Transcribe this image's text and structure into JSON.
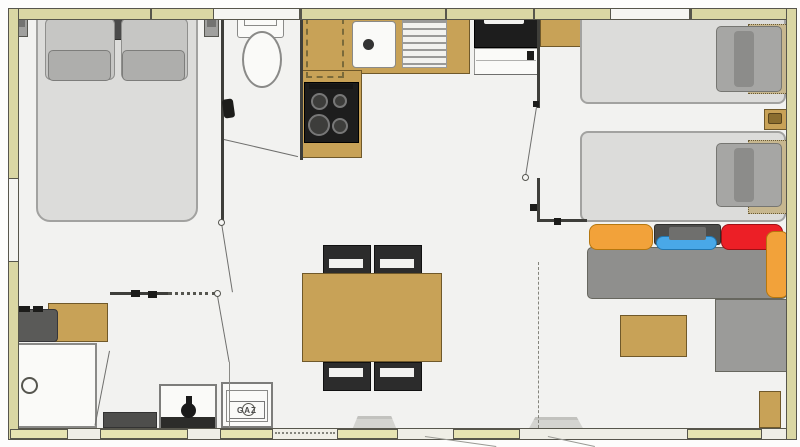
{
  "labels": {
    "gaz": "GAZ"
  },
  "colors": {
    "wall_band": "#dad7a4",
    "wall_band_border": "#57564c",
    "window_white": "#f5f5f2",
    "window_strip": "#e6e3b2",
    "bottom_band": "#efeee6",
    "wall_dark": "#3e3e3a",
    "floor": "#f2f2f0",
    "wood": "#c8a257",
    "wood_border": "#70592a",
    "wood_light": "#c7b78f",
    "wood_light_border": "#6b5b33",
    "mattress": "#dcdcda",
    "mattress_border": "#a2a2a0",
    "pillow": "#c6c6c4",
    "pillow_border": "#8f8f8d",
    "pillow_small": "#aeaeac",
    "pillow_twin": "#a6a6a4",
    "headboard": "#4a4a4a",
    "sofa": "#8f8f8d",
    "sofa_border": "#67675f",
    "chaise": "#9b9b99",
    "orange": "#f2a23a",
    "orange_border": "#b5770f",
    "red": "#ec1f26",
    "red_border": "#9e1116",
    "blue": "#49a8e8",
    "blue_border": "#2277b0",
    "dark_cushion": "#4e4e4c",
    "appliance": "#1d1d1d",
    "fixture": "#fafaf8",
    "fixture_border": "#8a8a88",
    "chair": "#2c2c2c",
    "line": "#6f6f6d",
    "basin": "#5a5a58",
    "gaz_text": "#4a4a4a"
  }
}
